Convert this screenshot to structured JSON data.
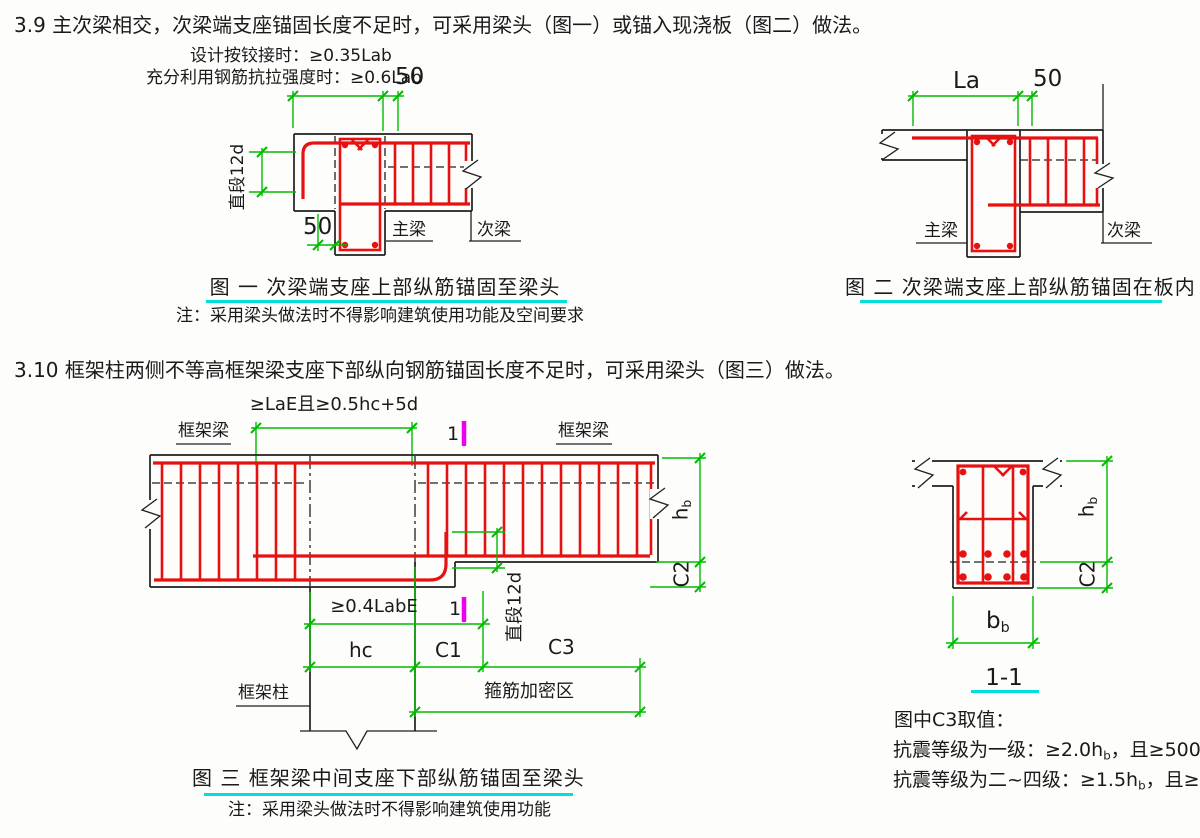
{
  "colors": {
    "line": "#1f1f1f",
    "rebar": "#e81111",
    "dim": "#00bb00",
    "cyan": "#00dede",
    "magenta": "#ee00ee",
    "bg": "#fdfdfc",
    "text": "#1a1a1a"
  },
  "sections": {
    "s39": "3.9 主次梁相交，次梁端支座锚固长度不足时，可采用梁头（图一）或锚入现浇板（图二）做法。",
    "s310": "3.10 框架柱两侧不等高框架梁支座下部纵向钢筋锚固长度不足时，可采用梁头（图三）做法。"
  },
  "fig1": {
    "dim_hinged": "设计按铰接时：≥0.35Lab",
    "dim_full_strength": "充分利用钢筋抗拉强度时：≥0.6Lab",
    "dim_50_top": "50",
    "dim_straight_segment": "直段12d",
    "dim_50_bottom": "50",
    "label_main_beam": "主梁",
    "label_secondary_beam": "次梁",
    "caption": "图 一  次梁端支座上部纵筋锚固至梁头",
    "note": "注：采用梁头做法时不得影响建筑使用功能及空间要求"
  },
  "fig2": {
    "dim_la": "La",
    "dim_50": "50",
    "label_main_beam": "主梁",
    "label_secondary_beam": "次梁",
    "caption": "图 二  次梁端支座上部纵筋锚固在板内"
  },
  "fig3": {
    "dim_top_anchorage": "≥LaE且≥0.5hc+5d",
    "label_frame_beam": "框架梁",
    "section_marker": "1",
    "dim_04labe": "≥0.4LabE",
    "dim_straight_segment": "直段12d",
    "dim_hb": {
      "main": "h",
      "sub": "b"
    },
    "dim_c2": "C2",
    "dim_hc": "hc",
    "dim_c1": "C1",
    "dim_c3": "C3",
    "label_frame_column": "框架柱",
    "label_stirrup_zone": "箍筋加密区",
    "caption": "图 三  框架梁中间支座下部纵筋锚固至梁头",
    "note": "注：采用梁头做法时不得影响建筑使用功能"
  },
  "section11": {
    "dim_hb": {
      "main": "h",
      "sub": "b"
    },
    "dim_c2": "C2",
    "dim_bb": {
      "main": "b",
      "sub": "b"
    },
    "title": "1-1",
    "notes_title": "图中C3取值：",
    "note_grade1": {
      "prefix": "抗震等级为一级：≥2.0h",
      "sub": "b",
      "suffix": "，且≥500"
    },
    "note_grade24": {
      "prefix": "抗震等级为二~四级：≥1.5h",
      "sub": "b",
      "suffix": "，且≥500"
    }
  }
}
